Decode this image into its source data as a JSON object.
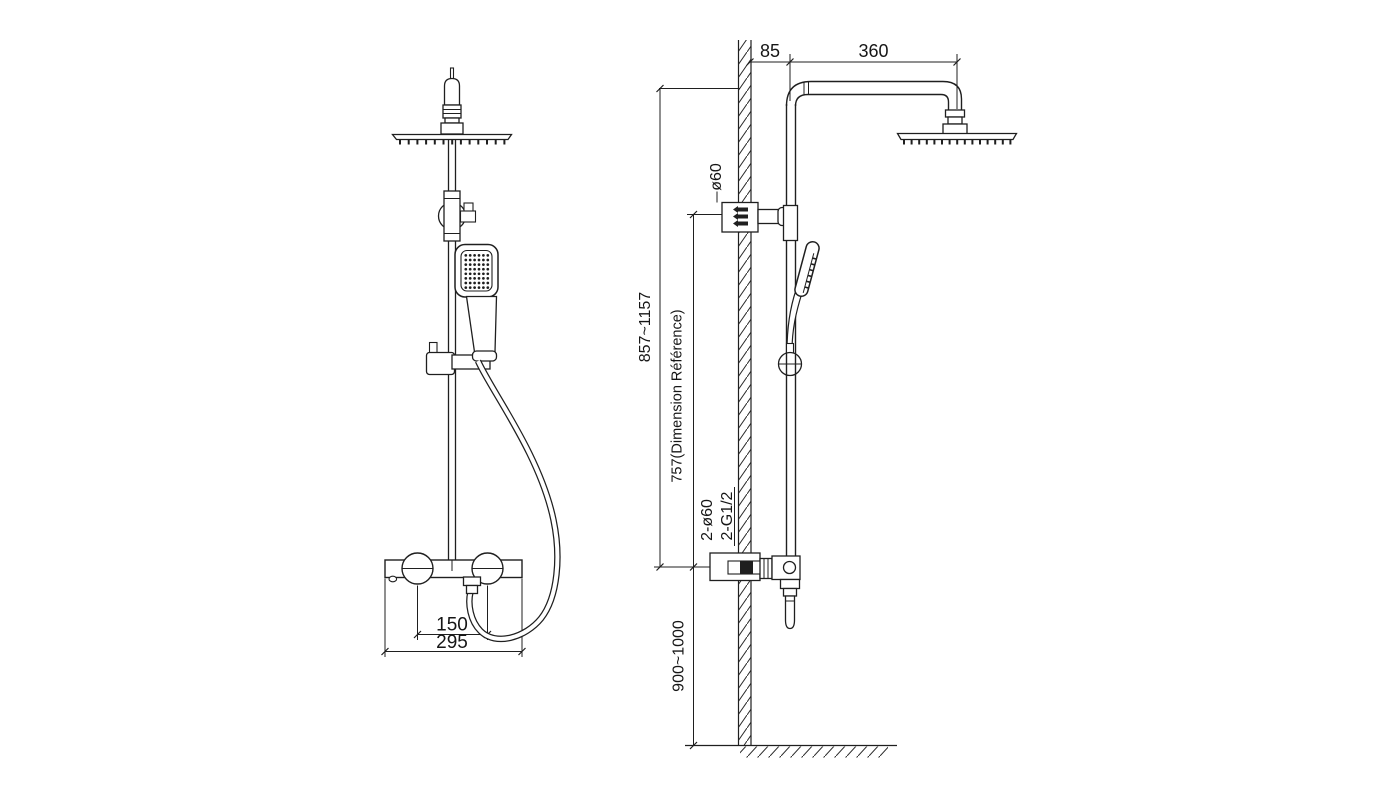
{
  "drawing": {
    "title": "shower-column-technical-drawing",
    "background": "#ffffff",
    "line_color": "#1f1f1f",
    "dims": {
      "wall_offset": "85",
      "arm_length": "360",
      "bracket_diameter": "ø60",
      "height_range": "857~1157",
      "reference_height": "757(Dimension Référence)",
      "inlet_diameter": "2-ø60",
      "inlet_thread": "2-G1/2",
      "install_height": "900~1000",
      "handle_spacing": "150",
      "valve_width": "295"
    }
  }
}
